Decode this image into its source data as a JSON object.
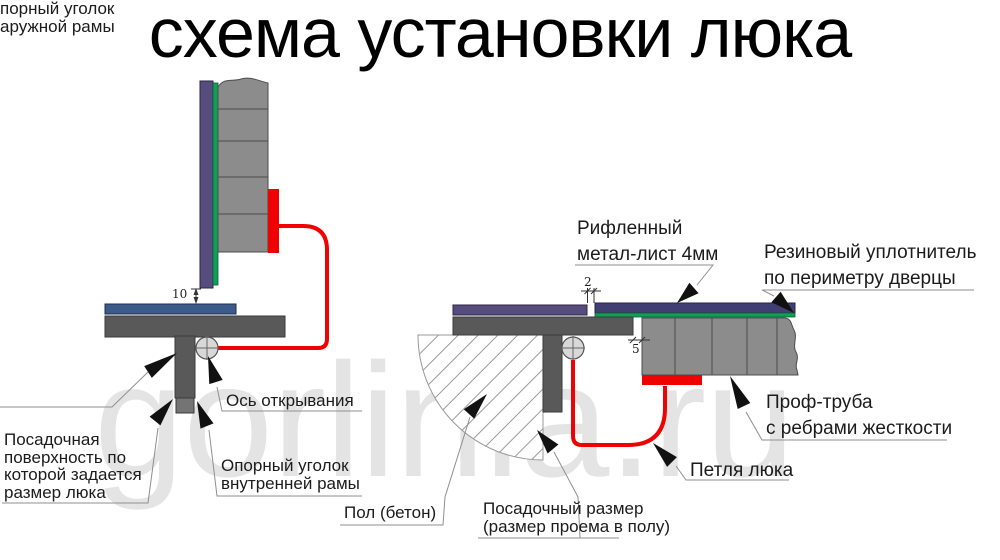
{
  "title": "схема установки люка",
  "watermark": "gorlinia.ru",
  "colors": {
    "hinge_red": "#ee0202",
    "outer_sheet_purple": "#564c7d",
    "door_sheet_purple": "#413e74",
    "seal_green": "#0fa057",
    "tube_gray": "#8c8c8c",
    "frame_dark_gray": "#595959",
    "angle_blue": "#3c5a8a",
    "watermark_gray": "#e4e4e4"
  },
  "left_diagram": {
    "dim_gap": "10",
    "labels": {
      "outer_corner": {
        "l1": "порный уголок",
        "l2": "аружной рамы"
      },
      "seating_surface": {
        "l1": "Посадочная",
        "l2": "поверхность по",
        "l3": "которой задается",
        "l4": "размер люка"
      },
      "axis": "Ось открывания",
      "inner_corner": {
        "l1": "Опорный уголок",
        "l2": "внутренней рамы"
      }
    }
  },
  "right_diagram": {
    "dim_sheet": "2",
    "dim_gap": "5",
    "labels": {
      "sheet": {
        "l1": "Рифленный",
        "l2": "метал-лист 4мм"
      },
      "seal": {
        "l1": "Резиновый уплотнитель",
        "l2": "по периметру дверцы"
      },
      "tube": {
        "l1": "Проф-труба",
        "l2": "с ребрами жесткости"
      },
      "hinge": "Петля люка",
      "floor": "Пол (бетон)",
      "opening": {
        "l1": "Посадочный размер",
        "l2": "(размер проема в полу)"
      }
    }
  }
}
